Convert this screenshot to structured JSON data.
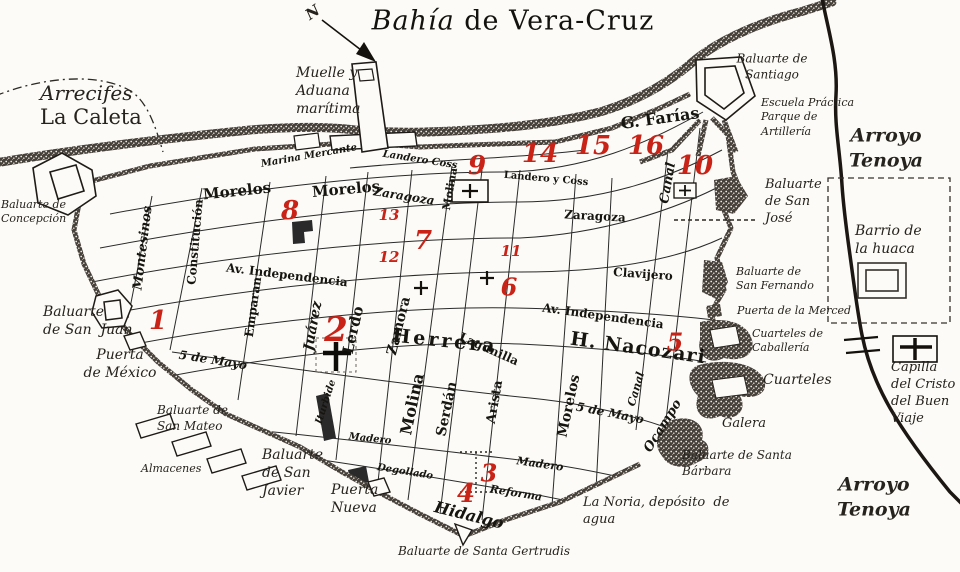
{
  "title": {
    "bahia": "Bahía",
    "rest": " de Vera-Cruz"
  },
  "compass": {
    "letter": "N"
  },
  "colors": {
    "red": "#c92318",
    "ink": "#201d18",
    "paper": "#fcfbf7",
    "wall": "#453f38"
  },
  "place_labels": [
    {
      "id": "label-arrecifes",
      "lines": [
        "Arrecifes"
      ],
      "x": 40,
      "y": 80,
      "size": 20,
      "italic": true
    },
    {
      "id": "label-la-caleta",
      "lines": [
        "La Caleta"
      ],
      "x": 40,
      "y": 104,
      "size": 21,
      "italic": false
    },
    {
      "id": "label-muelle-aduana",
      "lines": [
        "Muelle y",
        "Aduana",
        "marítima"
      ],
      "x": 296,
      "y": 64,
      "size": 14,
      "italic": true
    },
    {
      "id": "label-baluarte-concepcion",
      "lines": [
        "Baluarte de",
        "Concepción"
      ],
      "x": 1,
      "y": 198,
      "size": 11,
      "italic": true
    },
    {
      "id": "label-baluarte-santiago",
      "lines": [
        "Baluarte de",
        "Santiago"
      ],
      "x": 772,
      "y": 67,
      "size": 12,
      "italic": true,
      "align": "center"
    },
    {
      "id": "label-escuela-practica",
      "lines": [
        "Escuela Práctica",
        "Parque de",
        "Artillería"
      ],
      "x": 761,
      "y": 96,
      "size": 11,
      "italic": true
    },
    {
      "id": "label-arroyo-tenoya-norte",
      "lines": [
        "Arroyo",
        "Tenoya"
      ],
      "x": 886,
      "y": 148,
      "size": 19,
      "italic": true,
      "bold": true,
      "align": "center"
    },
    {
      "id": "label-baluarte-san-jose",
      "lines": [
        "Baluarte",
        "de San",
        "José"
      ],
      "x": 765,
      "y": 177,
      "size": 13,
      "italic": true
    },
    {
      "id": "label-barrio-huaca",
      "lines": [
        "Barrio de",
        "la huaca"
      ],
      "x": 855,
      "y": 222,
      "size": 14,
      "italic": true
    },
    {
      "id": "label-baluarte-san-fernando",
      "lines": [
        "Baluarte de",
        "San Fernando"
      ],
      "x": 736,
      "y": 265,
      "size": 11,
      "italic": true
    },
    {
      "id": "label-puerta-merced",
      "lines": [
        "Puerta de la Merced"
      ],
      "x": 737,
      "y": 304,
      "size": 11,
      "italic": true
    },
    {
      "id": "label-cuarteles-caballeria",
      "lines": [
        "Cuarteles de",
        "Caballería"
      ],
      "x": 752,
      "y": 327,
      "size": 11,
      "italic": true
    },
    {
      "id": "label-cuarteles",
      "lines": [
        "Cuarteles"
      ],
      "x": 763,
      "y": 371,
      "size": 14,
      "italic": true
    },
    {
      "id": "label-capilla-cristo",
      "lines": [
        "Capilla",
        "del Cristo",
        "del Buen",
        "Viaje"
      ],
      "x": 891,
      "y": 360,
      "size": 13,
      "italic": true
    },
    {
      "id": "label-galera",
      "lines": [
        "Galera"
      ],
      "x": 722,
      "y": 416,
      "size": 13,
      "italic": true
    },
    {
      "id": "label-baluarte-santa-barbara",
      "lines": [
        "Baluarte de Santa",
        "Bárbara"
      ],
      "x": 682,
      "y": 448,
      "size": 12,
      "italic": true
    },
    {
      "id": "label-la-noria",
      "lines": [
        "La Noria, depósito  de",
        "agua"
      ],
      "x": 583,
      "y": 495,
      "size": 13,
      "italic": true
    },
    {
      "id": "label-arroyo-tenoya-sur",
      "lines": [
        "Arroyo",
        "Tenoya"
      ],
      "x": 874,
      "y": 497,
      "size": 19,
      "italic": true,
      "bold": true,
      "align": "center"
    },
    {
      "id": "label-baluarte-santa-gertrudis",
      "lines": [
        "Baluarte de Santa Gertrudis"
      ],
      "x": 484,
      "y": 552,
      "size": 12,
      "italic": true,
      "align": "center"
    },
    {
      "id": "label-puerta-nueva",
      "lines": [
        "Puerta",
        "Nueva"
      ],
      "x": 331,
      "y": 481,
      "size": 14,
      "italic": true
    },
    {
      "id": "label-baluarte-san-javier",
      "lines": [
        "Baluarte",
        "de San",
        "Javier"
      ],
      "x": 262,
      "y": 446,
      "size": 14,
      "italic": true
    },
    {
      "id": "label-almacenes",
      "lines": [
        "Almacenes"
      ],
      "x": 141,
      "y": 462,
      "size": 11,
      "italic": true
    },
    {
      "id": "label-baluarte-san-mateo",
      "lines": [
        "Baluarte de",
        "San Mateo"
      ],
      "x": 157,
      "y": 403,
      "size": 12,
      "italic": true
    },
    {
      "id": "label-puerta-mexico",
      "lines": [
        "Puerta",
        "de México"
      ],
      "x": 120,
      "y": 364,
      "size": 14,
      "italic": true,
      "align": "center"
    },
    {
      "id": "label-baluarte-san-juan",
      "lines": [
        "Baluarte",
        "de San  Juan"
      ],
      "x": 43,
      "y": 303,
      "size": 14,
      "italic": true
    },
    {
      "id": "compass-n",
      "lines": [
        "N"
      ],
      "x": 313,
      "y": 13,
      "size": 15,
      "italic": true,
      "bold": true,
      "align": "center",
      "rotate": -35
    }
  ],
  "street_labels": [
    {
      "id": "street-morelos-oeste",
      "text": "Morelos",
      "x": 237,
      "y": 191,
      "r": -6,
      "size": 15
    },
    {
      "id": "street-morelos-centro",
      "text": "Morelos",
      "x": 346,
      "y": 189,
      "r": -5,
      "size": 15
    },
    {
      "id": "street-montesinos",
      "text": "Montesinos",
      "x": 143,
      "y": 248,
      "r": -83,
      "size": 13,
      "italic": true
    },
    {
      "id": "street-constitucion",
      "text": "Constitución",
      "x": 195,
      "y": 242,
      "r": -85,
      "size": 12
    },
    {
      "id": "street-emparan",
      "text": "Emparan",
      "x": 253,
      "y": 307,
      "r": -82,
      "size": 12
    },
    {
      "id": "street-av-independencia-oeste",
      "text": "Av. Independencia",
      "x": 287,
      "y": 275,
      "r": 7,
      "size": 12
    },
    {
      "id": "street-juarez",
      "text": "Juárez",
      "x": 313,
      "y": 326,
      "r": -80,
      "size": 14,
      "italic": true
    },
    {
      "id": "street-lerdo",
      "text": "Lerdo",
      "x": 353,
      "y": 330,
      "r": -77,
      "size": 15
    },
    {
      "id": "street-zamora",
      "text": "Zamora",
      "x": 399,
      "y": 326,
      "r": -76,
      "size": 14
    },
    {
      "id": "street-molina-norte",
      "text": "Molina",
      "x": 450,
      "y": 189,
      "r": -80,
      "size": 11
    },
    {
      "id": "street-molina-sur",
      "text": "Molina",
      "x": 412,
      "y": 404,
      "r": -78,
      "size": 16
    },
    {
      "id": "street-serdan",
      "text": "Serdán",
      "x": 447,
      "y": 409,
      "r": -78,
      "size": 14
    },
    {
      "id": "street-arista",
      "text": "Arista",
      "x": 495,
      "y": 402,
      "r": -80,
      "size": 13
    },
    {
      "id": "street-morelos-sur",
      "text": "Morelos",
      "x": 569,
      "y": 406,
      "r": -78,
      "size": 14
    },
    {
      "id": "street-5-de-mayo-oeste",
      "text": "5 de Mayo",
      "x": 213,
      "y": 360,
      "r": 9,
      "size": 12,
      "italic": true
    },
    {
      "id": "street-5-de-mayo-este",
      "text": "5 de Mayo",
      "x": 610,
      "y": 413,
      "r": 11,
      "size": 12,
      "italic": true
    },
    {
      "id": "street-canal-norte",
      "text": "Canal",
      "x": 668,
      "y": 183,
      "r": -80,
      "size": 13,
      "italic": true
    },
    {
      "id": "street-canal-sur",
      "text": "Canal",
      "x": 636,
      "y": 389,
      "r": -74,
      "size": 11,
      "italic": true
    },
    {
      "id": "street-ocampo",
      "text": "Ocampo",
      "x": 663,
      "y": 426,
      "r": -58,
      "size": 13,
      "italic": true
    },
    {
      "id": "street-herrera",
      "text": "Herrera",
      "x": 445,
      "y": 341,
      "r": 6,
      "size": 19,
      "spacing": 3
    },
    {
      "id": "street-h-nacozari",
      "text": "H. Nacozari",
      "x": 638,
      "y": 348,
      "r": 8,
      "size": 19,
      "spacing": 1
    },
    {
      "id": "street-clavijero",
      "text": "Clavijero",
      "x": 643,
      "y": 274,
      "r": 4,
      "size": 12
    },
    {
      "id": "street-av-independencia-este",
      "text": "Av. Independencia",
      "x": 603,
      "y": 316,
      "r": 8,
      "size": 12
    },
    {
      "id": "street-zaragoza-este",
      "text": "Zaragoza",
      "x": 595,
      "y": 216,
      "r": 3,
      "size": 12
    },
    {
      "id": "street-landero-y-coss",
      "text": "Landero y Coss",
      "x": 546,
      "y": 179,
      "r": 5,
      "size": 10
    },
    {
      "id": "street-landero-coss",
      "text": "Landero Coss",
      "x": 420,
      "y": 160,
      "r": 9,
      "size": 10,
      "italic": true
    },
    {
      "id": "street-zaragoza-norte",
      "text": "Zaragoza",
      "x": 404,
      "y": 196,
      "r": 9,
      "size": 12,
      "italic": true
    },
    {
      "id": "street-g-farias",
      "text": "G. Farías",
      "x": 660,
      "y": 118,
      "r": -8,
      "size": 16
    },
    {
      "id": "street-marina-mercante",
      "text": "Marina Mercante",
      "x": 309,
      "y": 156,
      "r": -10,
      "size": 10,
      "italic": true
    },
    {
      "id": "street-madero-oeste",
      "text": "Madero",
      "x": 370,
      "y": 439,
      "r": 6,
      "size": 10,
      "italic": true
    },
    {
      "id": "street-madero-este",
      "text": "Madero",
      "x": 540,
      "y": 464,
      "r": 8,
      "size": 11,
      "italic": true
    },
    {
      "id": "street-degollado",
      "text": "Degollado",
      "x": 405,
      "y": 472,
      "r": 9,
      "size": 10,
      "italic": true
    },
    {
      "id": "street-reforma",
      "text": "Reforma",
      "x": 516,
      "y": 493,
      "r": 9,
      "size": 11,
      "italic": true
    },
    {
      "id": "street-lagunilla",
      "text": "Lagunilla",
      "x": 489,
      "y": 349,
      "r": 24,
      "size": 12
    },
    {
      "id": "street-iturbide",
      "text": "Iturbide",
      "x": 326,
      "y": 402,
      "r": -72,
      "size": 10,
      "italic": true
    },
    {
      "id": "street-hidalgo",
      "text": "Hidalgo",
      "x": 469,
      "y": 515,
      "r": 14,
      "size": 16,
      "italic": true
    }
  ],
  "markers": [
    {
      "n": "1",
      "x": 158,
      "y": 321,
      "size": 26
    },
    {
      "n": "2",
      "x": 336,
      "y": 330,
      "size": 34
    },
    {
      "n": "3",
      "x": 489,
      "y": 473,
      "size": 24
    },
    {
      "n": "4",
      "x": 466,
      "y": 494,
      "size": 26
    },
    {
      "n": "5",
      "x": 675,
      "y": 342,
      "size": 24
    },
    {
      "n": "6",
      "x": 509,
      "y": 287,
      "size": 24
    },
    {
      "n": "7",
      "x": 423,
      "y": 241,
      "size": 26
    },
    {
      "n": "8",
      "x": 290,
      "y": 211,
      "size": 26
    },
    {
      "n": "9",
      "x": 477,
      "y": 166,
      "size": 26
    },
    {
      "n": "10",
      "x": 695,
      "y": 166,
      "size": 26
    },
    {
      "n": "11",
      "x": 511,
      "y": 251,
      "size": 15
    },
    {
      "n": "12",
      "x": 389,
      "y": 257,
      "size": 15
    },
    {
      "n": "13",
      "x": 389,
      "y": 215,
      "size": 15
    },
    {
      "n": "14",
      "x": 540,
      "y": 154,
      "size": 26
    },
    {
      "n": "15",
      "x": 593,
      "y": 146,
      "size": 26
    },
    {
      "n": "16",
      "x": 646,
      "y": 146,
      "size": 26
    }
  ]
}
